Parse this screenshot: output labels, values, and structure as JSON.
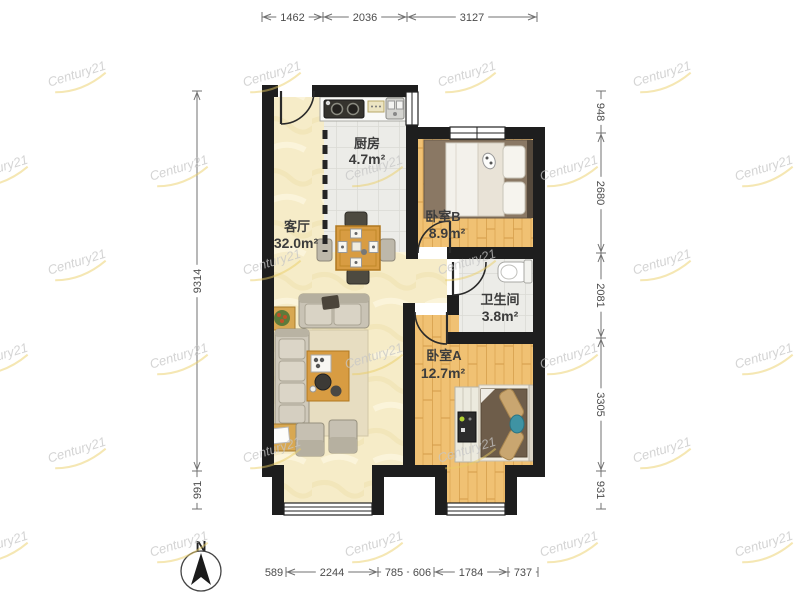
{
  "floorplan": {
    "compass_label": "N",
    "watermark_text": "Century21",
    "rooms": {
      "kitchen": {
        "name": "厨房",
        "area": "4.7m²"
      },
      "living_room": {
        "name": "客厅",
        "area": "32.0m²"
      },
      "bedroom_b": {
        "name": "卧室B",
        "area": "8.9m²"
      },
      "bathroom": {
        "name": "卫生间",
        "area": "3.8m²"
      },
      "bedroom_a": {
        "name": "卧室A",
        "area": "12.7m²"
      }
    },
    "dimensions_mm": {
      "top": [
        "1462",
        "2036",
        "3127"
      ],
      "left": [
        "9314",
        "991"
      ],
      "right": [
        "948",
        "2680",
        "2081",
        "3305",
        "931"
      ],
      "bottom": [
        "589",
        "2244",
        "785",
        "606",
        "1784",
        "737"
      ]
    },
    "colors": {
      "wall": "#1e1e1e",
      "living_floor": "#f6ecc8",
      "wood_floor": "#f0c173",
      "tile_floor": "#ecece8",
      "dimension_text": "#4c4c4c",
      "watermark_gray": "#c6c6c6",
      "watermark_gold": "#e9cd62"
    }
  }
}
